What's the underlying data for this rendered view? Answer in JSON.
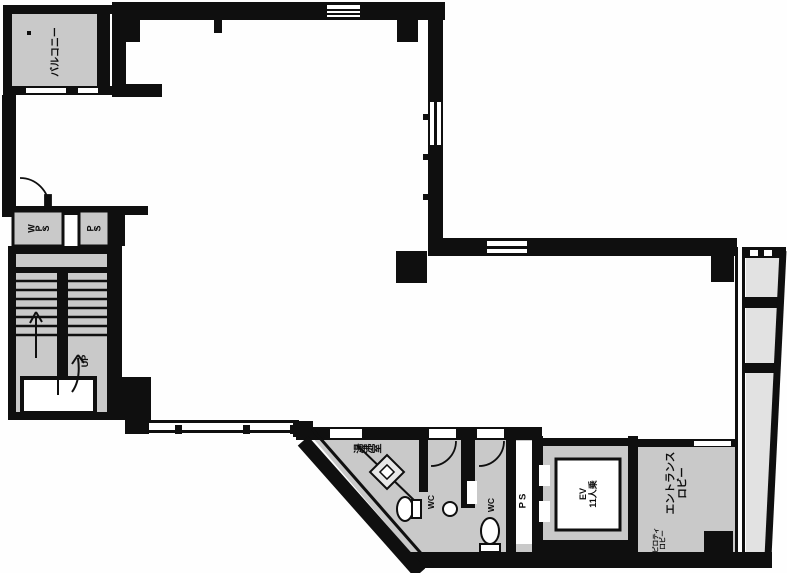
{
  "title": "2F floor plan",
  "colors": {
    "wall": "#0f0f0f",
    "floor_gray": "#c9c9c9",
    "panel_gray": "#e2e2e2",
    "background": "#fefefe",
    "room_white": "#ffffff"
  },
  "labels": {
    "balcony": "バルコニー",
    "wps_shaft": "W.P.S",
    "ps_shaft": "P.S",
    "stairs_up": "UP",
    "kitchenette": "湯沸室",
    "wc1": "WC",
    "wc2": "WC",
    "ps_core": "PS",
    "elevator": {
      "line1": "EV",
      "line2": "11人乗"
    },
    "lobby": {
      "line1": "エントランス",
      "line2": "ロビー"
    },
    "lobby_small": {
      "line1": "ピロティ",
      "line2": "ロビー"
    }
  }
}
